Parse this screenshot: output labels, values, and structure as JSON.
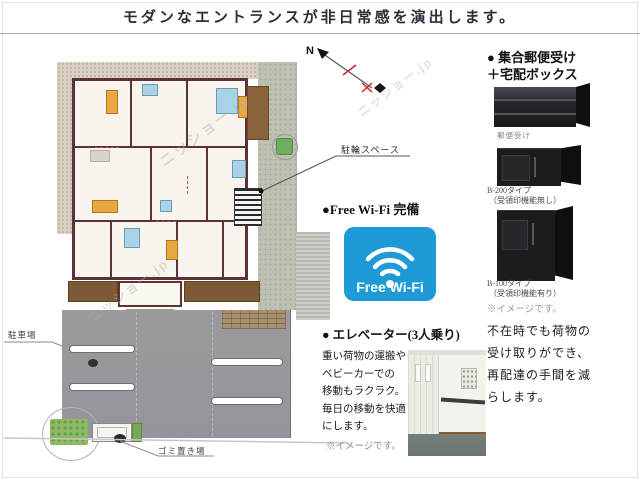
{
  "title": "モダンなエントランスが非日常感を演出します。",
  "floorplan": {
    "compass": "N",
    "bicycle_label": "駐輪スペース",
    "parking_label": "駐車場",
    "garbage_label": "ゴミ置き場",
    "watermark": "ニッショー.jp"
  },
  "wifi": {
    "heading": "●Free Wi-Fi 完備",
    "badge_label": "Free Wi-Fi",
    "badge_color": "#1e9bd7"
  },
  "elevator": {
    "heading": "● エレベーター(3人乗り)",
    "body": "重い荷物の運搬や\nベビーカーでの\n移動もラクラク。\n毎日の移動を快適\nにします。",
    "note": "※イメージです。"
  },
  "mail": {
    "heading1": "● 集合郵便受け",
    "heading2": "＋宅配ボックス",
    "mailbox_caption": "郵便受け",
    "box_a": {
      "line1": "B-200タイプ",
      "line2": "（受領印機能無し）"
    },
    "box_b": {
      "line1": "B-100タイプ",
      "line2": "（受領印機能有り）"
    },
    "note": "※イメージです。",
    "body": "不在時でも荷物の\n受け取りができ、\n再配達の手間を減\nらします。"
  },
  "colors": {
    "wall_maroon": "#5c3138",
    "balcony_brown": "#7b5a35",
    "wifi_blue": "#1e9bd7"
  }
}
